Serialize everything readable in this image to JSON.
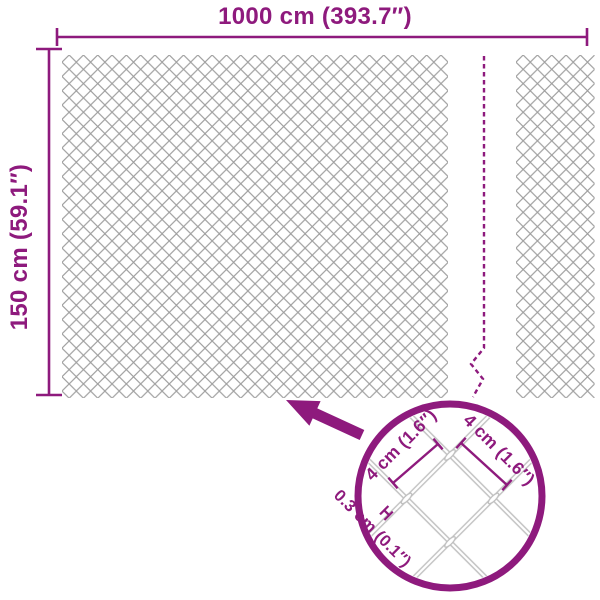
{
  "diagram": {
    "kind": "product-dimension-diagram",
    "subject": "chain-link fence mesh panel"
  },
  "overall": {
    "width_label": "1000 cm (393.7″)",
    "height_label": "150 cm (59.1″)"
  },
  "detail_callout": {
    "mesh_width_label": "4 cm (1.6″)",
    "mesh_height_label": "4 cm (1.6″)",
    "wire_thickness_label": "0.3 cm (0.1″)"
  },
  "theme": {
    "accent": "#8E1A7D",
    "mesh-stroke": "#9D9D9D",
    "wire-stroke": "#BDBDBD",
    "background": "#FFFFFF"
  }
}
